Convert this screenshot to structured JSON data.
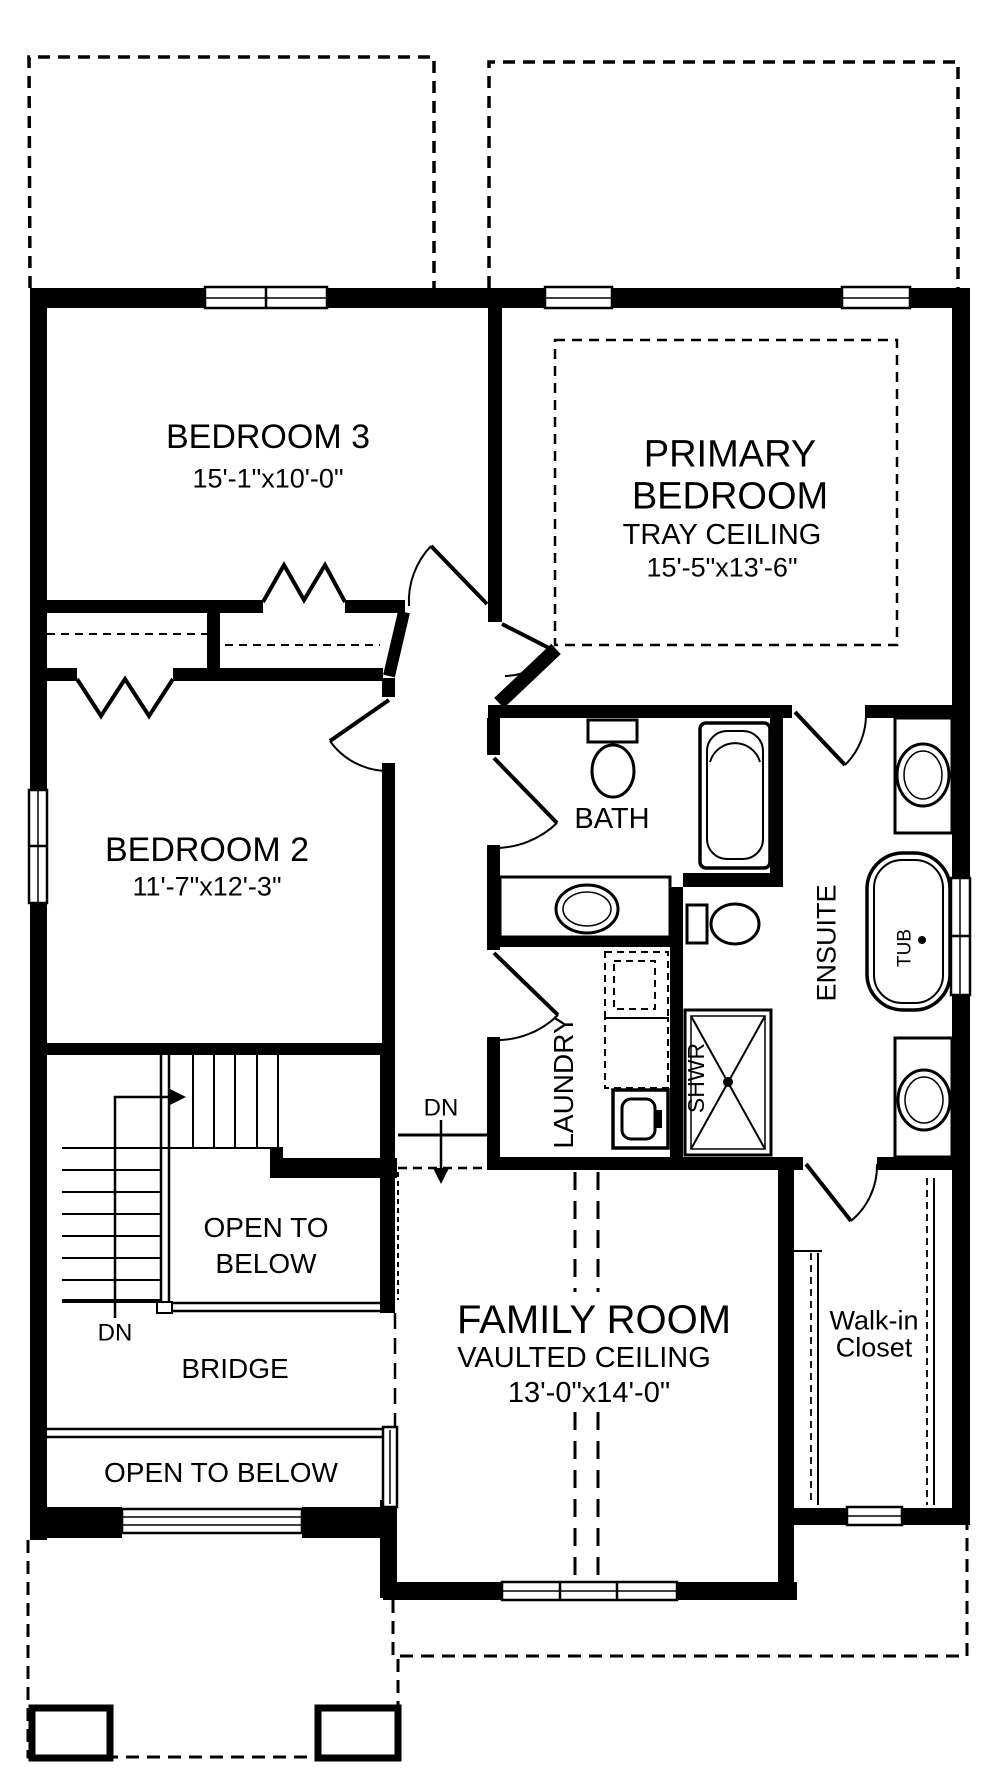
{
  "rooms": {
    "bedroom3": {
      "name": "BEDROOM 3",
      "dims": "15'-1\"x10'-0\""
    },
    "primary_bedroom": {
      "name_line1": "PRIMARY",
      "name_line2": "BEDROOM",
      "ceiling": "TRAY CEILING",
      "dims": "15'-5\"x13'-6\""
    },
    "bedroom2": {
      "name": "BEDROOM 2",
      "dims": "11'-7\"x12'-3\""
    },
    "bath": {
      "name": "BATH"
    },
    "ensuite": {
      "name": "ENSUITE"
    },
    "laundry": {
      "name": "LAUNDRY"
    },
    "family_room": {
      "name": "FAMILY ROOM",
      "ceiling": "VAULTED CEILING",
      "dims": "13'-0\"x14'-0\""
    },
    "walk_in_closet": {
      "name_line1": "Walk-in",
      "name_line2": "Closet"
    },
    "bridge": {
      "name": "BRIDGE"
    },
    "open_to_below_upper": {
      "name_line1": "OPEN TO",
      "name_line2": "BELOW"
    },
    "open_to_below_lower": {
      "name": "OPEN TO BELOW"
    }
  },
  "fixtures": {
    "tub_label": "TUB",
    "shower_label": "SHWR"
  },
  "stairs": {
    "down_label_stairs": "DN",
    "down_label_family": "DN"
  },
  "colors": {
    "line": "#000000",
    "background": "#ffffff"
  }
}
